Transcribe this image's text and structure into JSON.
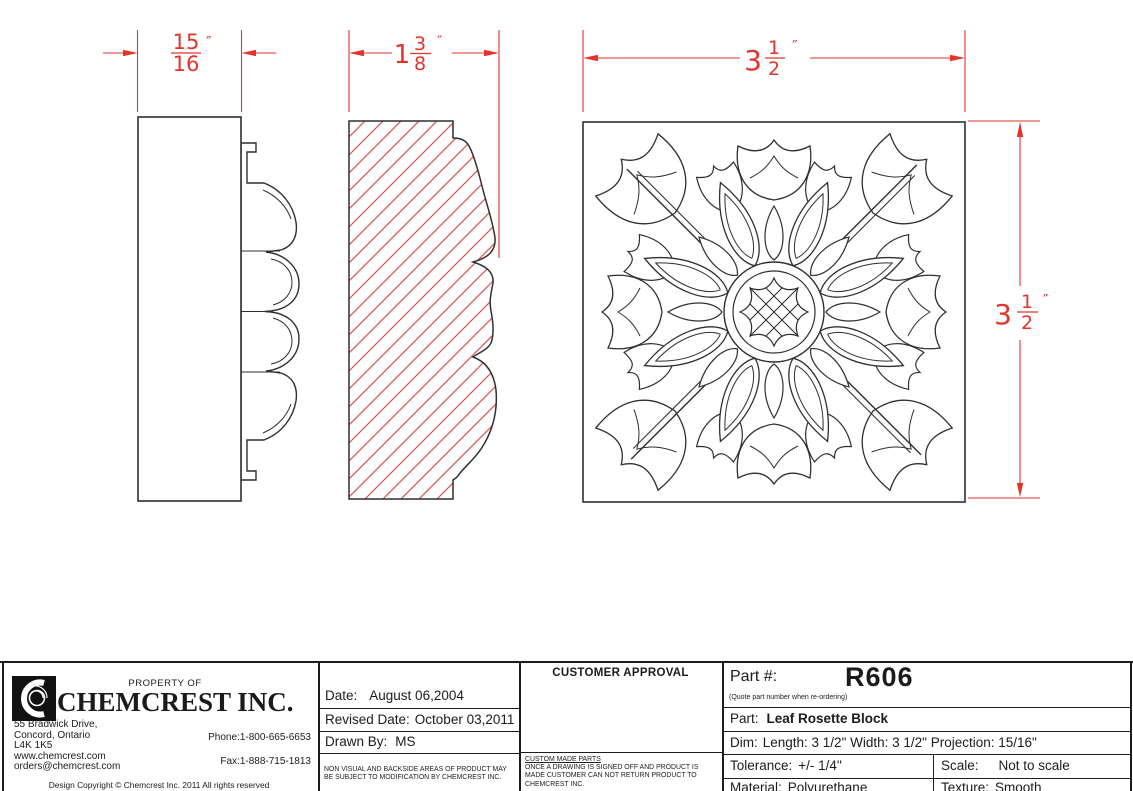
{
  "colors": {
    "dimension_red": "#e3342b",
    "hatch_red": "#d9534f",
    "line_black": "#2f2f2f"
  },
  "dims": {
    "side_width": {
      "num": "15",
      "den": "16",
      "unit": "″"
    },
    "section_depth": {
      "whole": "1",
      "num": "3",
      "den": "8",
      "unit": "″"
    },
    "front_width": {
      "whole": "3",
      "num": "1",
      "den": "2",
      "unit": "″"
    },
    "front_height": {
      "whole": "3",
      "num": "1",
      "den": "2",
      "unit": "″"
    }
  },
  "title_block": {
    "company": {
      "property_of": "PROPERTY OF",
      "name": "CHEMCREST INC.",
      "address_lines": [
        "55 Bradwick Drive,",
        "Concord, Ontario",
        "L4K 1K5",
        "www.chemcrest.com",
        "orders@chemcrest.com"
      ],
      "phone_label": "Phone:",
      "phone": "1-800-665-6653",
      "fax_label": "Fax:",
      "fax": "1-888-715-1813",
      "copyright": "Design Copyright © Chemcrest Inc. 2011 All rights reserved"
    },
    "revision": {
      "date_label": "Date:",
      "date": "August 06,2004",
      "revised_label": "Revised Date:",
      "revised": "October 03,2011",
      "drawn_by_label": "Drawn By:",
      "drawn_by": "MS",
      "disclaimer": "NON VISUAL AND BACKSIDE AREAS OF PRODUCT MAY BE SUBJECT TO MODIFICATION BY CHEMCREST INC."
    },
    "approval": {
      "title": "CUSTOMER APPROVAL",
      "note_title": "CUSTOM MADE PARTS",
      "note": "ONCE A DRAWING IS SIGNED OFF AND PRODUCT IS MADE CUSTOMER CAN NOT RETURN PRODUCT TO CHEMCREST INC."
    },
    "part": {
      "part_no_label": "Part #:",
      "part_no": "R606",
      "reorder_note": "(Quote part number when re-ordering)",
      "part_label": "Part:",
      "part_name": "Leaf Rosette Block",
      "dim_label": "Dim:",
      "dim_value": "Length: 3 1/2\" Width: 3 1/2\" Projection: 15/16\"",
      "tolerance_label": "Tolerance:",
      "tolerance": "+/- 1/4\"",
      "scale_label": "Scale:",
      "scale": "Not to scale",
      "material_label": "Material:",
      "material": "Polyurethane",
      "texture_label": "Texture:",
      "texture": "Smooth"
    }
  }
}
